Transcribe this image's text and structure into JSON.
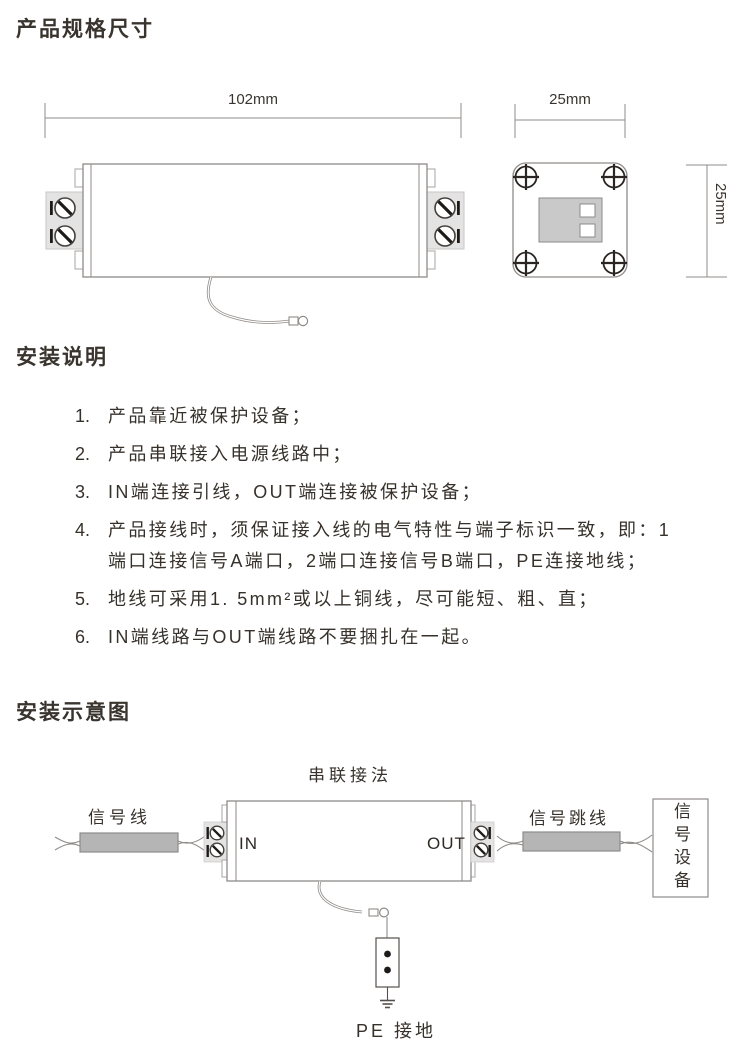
{
  "sections": {
    "spec_title": "产品规格尺寸",
    "install_title": "安装说明",
    "diagram_title": "安装示意图"
  },
  "spec_drawing": {
    "dim_width": "102mm",
    "dim_depth": "25mm",
    "dim_height": "25mm"
  },
  "install_steps": [
    {
      "num": "1.",
      "text": "产品靠近被保护设备；"
    },
    {
      "num": "2.",
      "text": "产品串联接入电源线路中；"
    },
    {
      "num": "3.",
      "text": "IN端连接引线，OUT端连接被保护设备；"
    },
    {
      "num": "4.",
      "text": "产品接线时，须保证接入线的电气特性与端子标识一致，即：1端口连接信号A端口，2端口连接信号B端口，PE连接地线；"
    },
    {
      "num": "5.",
      "text": "地线可采用1. 5mm²或以上铜线，尽可能短、粗、直；"
    },
    {
      "num": "6.",
      "text": "IN端线路与OUT端线路不要捆扎在一起。"
    }
  ],
  "diagram": {
    "caption": "串联接法",
    "signal_line_label": "信号线",
    "in_label": "IN",
    "out_label": "OUT",
    "jumper_label": "信号跳线",
    "device_label": "信号设备",
    "ground_label": "PE 接地"
  },
  "colors": {
    "ink": "#3a342e",
    "outline_gray": "#8f8b88",
    "terminal_fill": "#e3e3e3",
    "cable_fill": "#b5b5b5",
    "detail_dark": "#1e1a18"
  }
}
